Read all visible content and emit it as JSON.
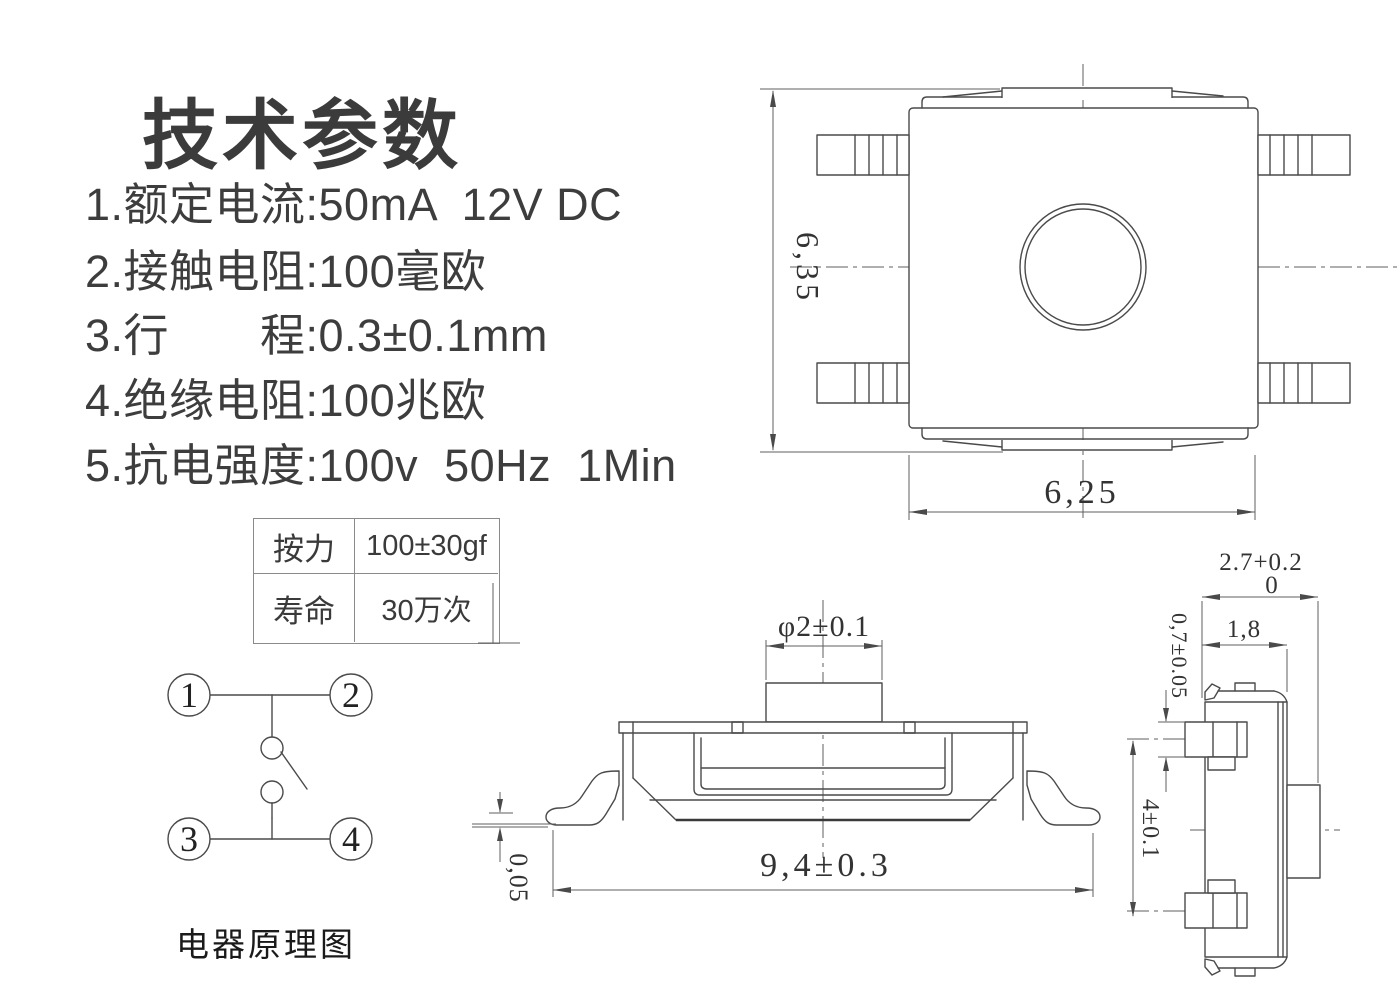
{
  "title": "技术参数",
  "specs": {
    "items": [
      "1.额定电流:50mA  12V DC",
      "2.接触电阻:100毫欧",
      "3.行　　程:0.3±0.1mm",
      "4.绝缘电阻:100兆欧",
      "5.抗电强度:100v  50Hz  1Min"
    ]
  },
  "table": {
    "row1_label": "按力",
    "row1_value": "100±30gf",
    "row2_label": "寿命",
    "row2_value": "30万次"
  },
  "schematic": {
    "caption": "电器原理图",
    "terminals": [
      "1",
      "2",
      "3",
      "4"
    ]
  },
  "dims": {
    "top_view_height": "6,35",
    "top_view_width": "6,25",
    "front_button_dia": "φ2±0.1",
    "front_total_width": "9,4±0.3",
    "front_standoff": "0,05",
    "side_depth": "2.7+0.2",
    "side_depth_tol_low": "0",
    "side_body_depth": "1,8",
    "side_pin_thickness": "0,7±0.05",
    "side_pin_pitch": "4±0.1"
  },
  "colors": {
    "drawing_line": "#4a4a4a",
    "dimension_line": "#5f5f5f",
    "text": "#3d3d3d",
    "table_border": "#8a8a8a",
    "background": "#ffffff"
  }
}
